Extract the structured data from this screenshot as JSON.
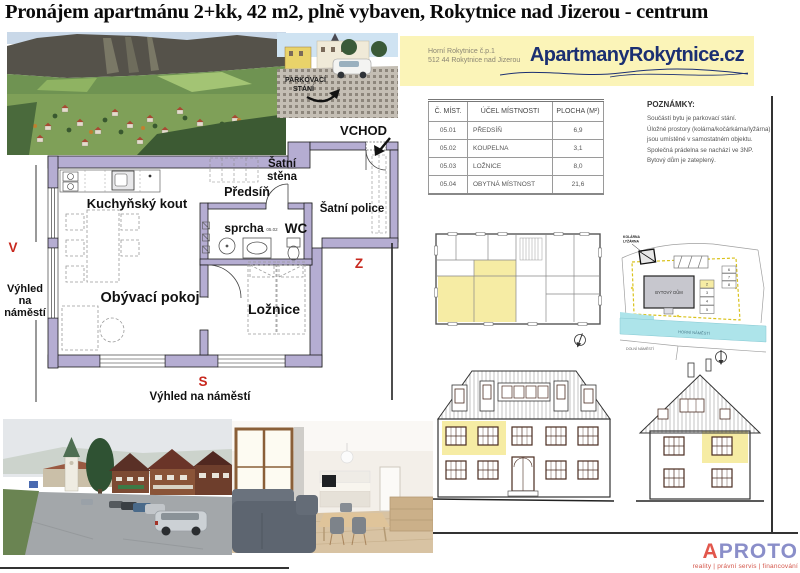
{
  "title": "Pronájem apartmánu 2+kk, 42 m2, plně vybaven, Rokytnice nad Jizerou - centrum",
  "colors": {
    "wall_lavender": "#b5add2",
    "apartment_highlight": "#f6eca4",
    "compass_red": "#c8281e",
    "header_bg": "#fbf4b8",
    "brand_navy": "#1b2f72",
    "logo_red": "#e2574c",
    "logo_violet": "#8a8ec9",
    "road_cyan": "#ade4ea"
  },
  "header": {
    "address_line1": "Horní Rokytnice č.p.1",
    "address_line2": "512 44 Rokytnice nad Jizerou",
    "site": "ApartmanyRokytnice.cz"
  },
  "parking_photo": {
    "label_line1": "PARKOVACÍ",
    "label_line2": "STÁNÍ"
  },
  "room_table": {
    "headers": [
      "Č. MÍST.",
      "ÚČEL MÍSTNOSTI",
      "PLOCHA (M²)"
    ],
    "rows": [
      [
        "05.01",
        "PŘEDSÍŇ",
        "6,9"
      ],
      [
        "05.02",
        "KOUPELNA",
        "3,1"
      ],
      [
        "05.03",
        "LOŽNICE",
        "8,0"
      ],
      [
        "05.04",
        "OBYTNÁ MÍSTNOST",
        "21,6"
      ]
    ]
  },
  "notes": {
    "heading": "POZNÁMKY:",
    "lines": [
      "Součástí bytu je parkovací stání.",
      "Úložné prostory (kolárna/kočárkárna/lyžárna)",
      "jsou umístěné v samostatném objektu.",
      "Společná prádelna se nachází ve 3NP.",
      "Bytový dům je zateplený."
    ]
  },
  "floor_plan": {
    "entrance": "VCHOD",
    "kitchen": "Kuchyňský kout",
    "hall": "Předsíň",
    "closet_line1": "Šatní",
    "closet_line2": "stěna",
    "shelf": "Šatní police",
    "shower": "sprcha",
    "bath_number": "05.02",
    "wc": "WC",
    "living": "Obývací pokoj",
    "bedroom": "Ložnice",
    "compass_east": "V",
    "compass_west": "Z",
    "compass_south": "S",
    "view_left_line1": "Výhled",
    "view_left_line2": "na",
    "view_left_line3": "náměstí",
    "view_bottom": "Výhled na náměstí"
  },
  "site_plan": {
    "storage_line1": "KOLÁRNA",
    "storage_line2": "LYŽÁRNA",
    "building": "BYTOVÝ DŮM",
    "road_band": "HORNÍ NÁMĚSTÍ",
    "square": "DOLNÍ NÁMĚSTÍ",
    "parking_numbers": [
      "2",
      "3",
      "4",
      "5",
      "6",
      "7",
      "8"
    ]
  },
  "footer": {
    "logo_a": "A",
    "logo_rest": "PROTO",
    "tagline": "reality | právní servis | financování"
  }
}
